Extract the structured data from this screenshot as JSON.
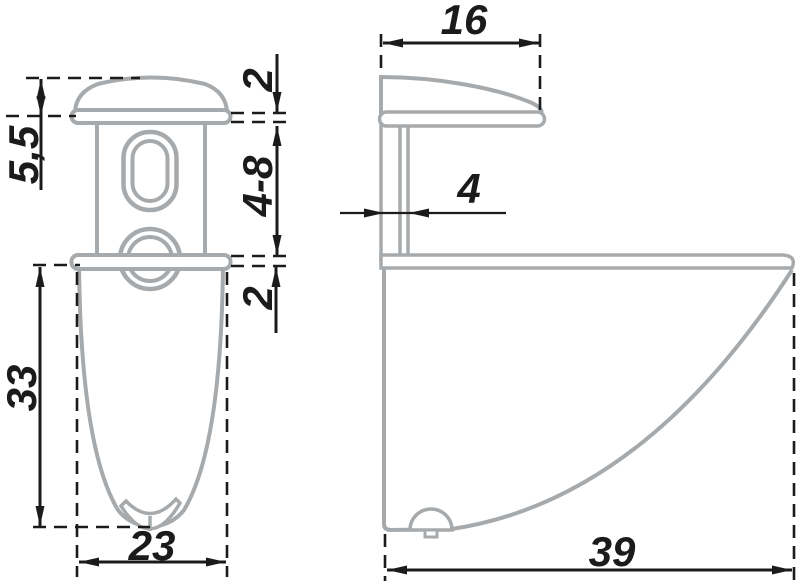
{
  "drawing": {
    "type": "technical-dimension-drawing",
    "part": "shelf-support-bracket",
    "colors": {
      "outline": "#a7aaac",
      "dimension": "#1b1b1b",
      "background": "#ffffff"
    },
    "dimensions": {
      "front": {
        "cap_height": "5,5",
        "cap_rim": "2",
        "gap_range": "4-8",
        "base_rim": "2",
        "body_length": "33",
        "width": "23"
      },
      "side": {
        "cap_depth": "16",
        "pin_width": "4",
        "depth": "39"
      }
    }
  }
}
